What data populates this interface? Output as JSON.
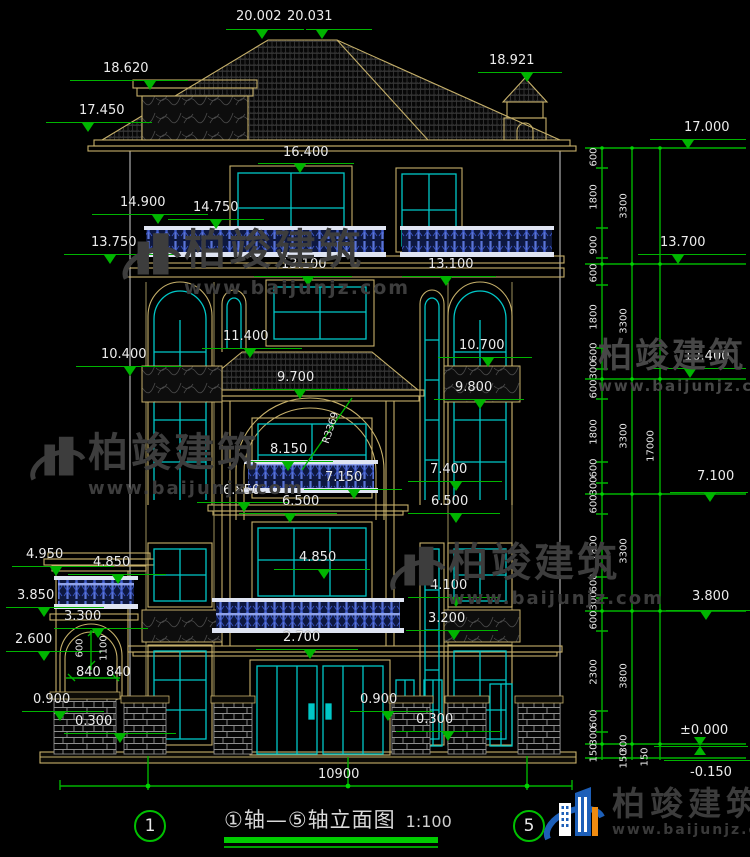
{
  "drawing": {
    "type": "building front elevation, CAD style on black",
    "colors": {
      "dim_green": "#00b400",
      "line_tan": "#c6b06a",
      "window_cyan": "#00c8c8",
      "railing_blue": "#3a56c8",
      "text_white": "#ececec",
      "watermark_gray": "#3d3d3d",
      "logo_blue": "#1d5fb8",
      "logo_orange": "#ef8b10"
    }
  },
  "title_block": {
    "axis_left": "1",
    "axis_right": "5",
    "title": "①轴—⑤轴立面图",
    "scale": "1:100"
  },
  "watermark": {
    "brand": "柏竣建筑",
    "url": "www.baijunjz.com"
  },
  "logo": {
    "brand": "柏竣建筑",
    "url": "www.baijunjz.com"
  },
  "markers": [
    [
      "20.002",
      236,
      10,
      226,
      78,
      29,
      262,
      "t"
    ],
    [
      "20.031",
      287,
      10,
      306,
      66,
      29,
      322,
      "t"
    ],
    [
      "18.620",
      103,
      62,
      70,
      118,
      80,
      150,
      "t"
    ],
    [
      "17.450",
      79,
      104,
      46,
      106,
      122,
      88,
      "t"
    ],
    [
      "18.921",
      489,
      54,
      478,
      84,
      72,
      527,
      "t"
    ],
    [
      "17.000",
      684,
      121,
      650,
      96,
      139,
      688,
      "t"
    ],
    [
      "16.400",
      283,
      146,
      258,
      96,
      163,
      300,
      "t"
    ],
    [
      "14.900",
      120,
      196,
      92,
      116,
      214,
      158,
      "t"
    ],
    [
      "14.750",
      193,
      201,
      168,
      96,
      219,
      216,
      "t"
    ],
    [
      "13.750",
      91,
      236,
      64,
      110,
      254,
      110,
      "t"
    ],
    [
      "13.100",
      281,
      258,
      254,
      98,
      276,
      308,
      "t"
    ],
    [
      "13.100",
      428,
      258,
      402,
      94,
      276,
      446,
      "t"
    ],
    [
      "13.700",
      660,
      236,
      638,
      108,
      254,
      678,
      "t"
    ],
    [
      "11.400",
      223,
      330,
      202,
      100,
      348,
      250,
      "t"
    ],
    [
      "10.400",
      101,
      348,
      76,
      106,
      366,
      130,
      "t"
    ],
    [
      "10.700",
      459,
      339,
      438,
      94,
      357,
      488,
      "t"
    ],
    [
      "10.400",
      684,
      350,
      650,
      96,
      368,
      690,
      "t"
    ],
    [
      "9.800",
      455,
      381,
      434,
      90,
      399,
      480,
      "t"
    ],
    [
      "9.700",
      277,
      371,
      252,
      96,
      389,
      300,
      "t"
    ],
    [
      "8.150",
      270,
      443,
      247,
      86,
      461,
      288,
      "t"
    ],
    [
      "7.150",
      325,
      471,
      304,
      98,
      489,
      354,
      "t"
    ],
    [
      "6.850",
      223,
      484,
      197,
      92,
      502,
      244,
      "t"
    ],
    [
      "6.500",
      282,
      495,
      239,
      98,
      513,
      290,
      "t"
    ],
    [
      "7.400",
      430,
      463,
      408,
      94,
      481,
      456,
      "t"
    ],
    [
      "6.500",
      431,
      495,
      408,
      92,
      513,
      456,
      "t"
    ],
    [
      "7.100",
      697,
      470,
      670,
      78,
      492,
      710,
      "t"
    ],
    [
      "4.950",
      26,
      548,
      12,
      102,
      566,
      56,
      "t"
    ],
    [
      "4.850",
      93,
      556,
      68,
      98,
      574,
      118,
      "t"
    ],
    [
      "4.850",
      299,
      551,
      274,
      96,
      569,
      324,
      "t"
    ],
    [
      "3.850",
      17,
      589,
      6,
      98,
      607,
      44,
      "t"
    ],
    [
      "3.300",
      64,
      610,
      54,
      94,
      628,
      98,
      "t"
    ],
    [
      "3.800",
      692,
      590,
      666,
      84,
      610,
      706,
      "t"
    ],
    [
      "4.100",
      430,
      579,
      408,
      92,
      597,
      456,
      "t"
    ],
    [
      "3.200",
      428,
      612,
      406,
      92,
      630,
      454,
      "t"
    ],
    [
      "2.700",
      283,
      631,
      256,
      102,
      649,
      310,
      "t"
    ],
    [
      "2.600",
      15,
      633,
      6,
      96,
      651,
      44,
      "t"
    ],
    [
      "0.900",
      33,
      693,
      22,
      82,
      711,
      60,
      "t"
    ],
    [
      "0.300",
      75,
      715,
      64,
      112,
      733,
      120,
      "t"
    ],
    [
      "0.900",
      360,
      693,
      350,
      82,
      711,
      388,
      "t"
    ],
    [
      "0.300",
      416,
      713,
      396,
      106,
      731,
      448,
      "t"
    ],
    [
      "±0.000",
      680,
      724,
      654,
      94,
      746,
      700,
      "x"
    ],
    [
      "-0.150",
      690,
      766,
      664,
      86,
      760,
      0,
      "n"
    ]
  ],
  "chain_dims": [
    [
      "600",
      594,
      157,
      -90
    ],
    [
      "1800",
      594,
      197,
      -90
    ],
    [
      "900",
      594,
      245,
      -90
    ],
    [
      "600",
      594,
      273,
      -90
    ],
    [
      "1800",
      594,
      317,
      -90
    ],
    [
      "600",
      594,
      352,
      -90
    ],
    [
      "300",
      594,
      370,
      -90
    ],
    [
      "600",
      594,
      389,
      -90
    ],
    [
      "1800",
      594,
      432,
      -90
    ],
    [
      "600",
      594,
      468,
      -90
    ],
    [
      "300",
      594,
      486,
      -90
    ],
    [
      "600",
      594,
      504,
      -90
    ],
    [
      "1800",
      594,
      548,
      -90
    ],
    [
      "600",
      594,
      583,
      -90
    ],
    [
      "300",
      594,
      601,
      -90
    ],
    [
      "600",
      594,
      620,
      -90
    ],
    [
      "2300",
      594,
      672,
      -90
    ],
    [
      "600",
      594,
      719,
      -90
    ],
    [
      "300",
      594,
      736,
      -90
    ],
    [
      "150",
      594,
      753,
      -90
    ],
    [
      "3300",
      624,
      206,
      -90
    ],
    [
      "3300",
      624,
      321,
      -90
    ],
    [
      "3300",
      624,
      436,
      -90
    ],
    [
      "3300",
      624,
      551,
      -90
    ],
    [
      "3800",
      624,
      676,
      -90
    ],
    [
      "300",
      624,
      744,
      -90
    ],
    [
      "150",
      624,
      759,
      -90
    ],
    [
      "17000",
      651,
      446,
      -90
    ],
    [
      "150",
      645,
      757,
      -90
    ],
    [
      "600",
      80,
      648,
      -90
    ],
    [
      "1100",
      104,
      648,
      -90
    ],
    [
      "R3369",
      331,
      428,
      -72
    ]
  ],
  "plain_dims": [
    [
      "10900",
      318,
      767
    ],
    [
      "840",
      76,
      665
    ],
    [
      "840",
      106,
      665
    ]
  ]
}
